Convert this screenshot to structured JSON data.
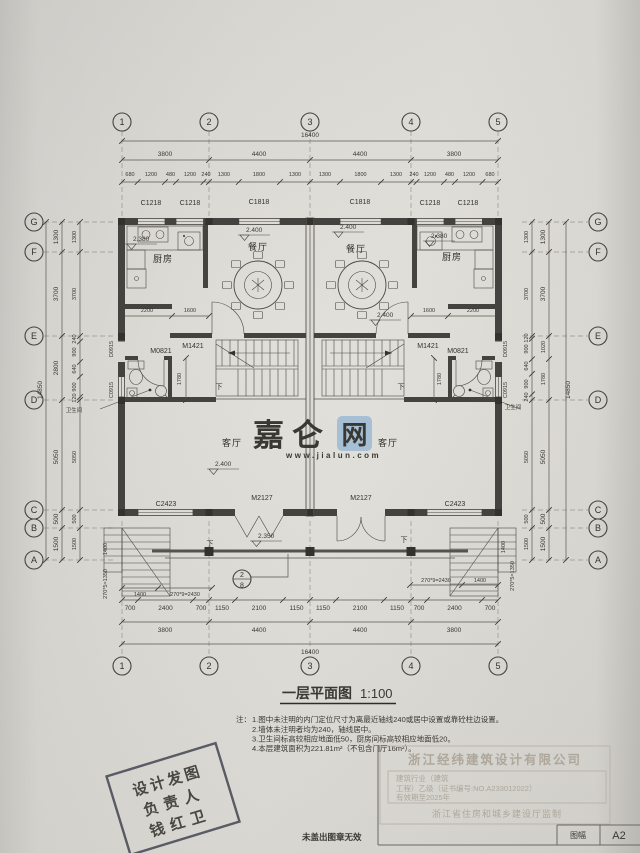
{
  "grid": {
    "cols": [
      "1",
      "2",
      "3",
      "4",
      "5"
    ],
    "rows": [
      "G",
      "F",
      "E",
      "D",
      "C",
      "B",
      "A"
    ]
  },
  "dims": {
    "top_total": "16400",
    "bays": [
      "3800",
      "4400",
      "4400",
      "3800"
    ],
    "top_detail": [
      "680",
      "1200",
      "480",
      "1200",
      "240",
      "1300",
      "1800",
      "1300",
      "1300",
      "1800",
      "1300",
      "240",
      "1200",
      "480",
      "1200",
      "680"
    ],
    "bottom_total": "16400",
    "bottom_detail": [
      "700",
      "2400",
      "700",
      "1150",
      "2100",
      "1150",
      "1150",
      "2100",
      "1150",
      "700",
      "2400",
      "700"
    ],
    "left_outer": [
      "1300",
      "3700",
      "2800",
      "5050",
      "500",
      "1500"
    ],
    "left_inner": [
      "1300",
      "3700",
      "240",
      "900",
      "640",
      "900",
      "120",
      "5050",
      "500",
      "1500"
    ],
    "right_inner": [
      "1300",
      "3700",
      "120",
      "900",
      "640",
      "900",
      "240",
      "5050",
      "500",
      "1500"
    ],
    "right_mid": [
      "1300",
      "3700",
      "1020",
      "1780",
      "5050",
      "500",
      "1500"
    ],
    "side_total": "14850",
    "kitchen_left": [
      "2200",
      "1600"
    ],
    "kitchen_right": [
      "1600",
      "2200"
    ],
    "stair_depth": "1780",
    "entry_left": [
      "1400",
      "270*9=2430"
    ],
    "entry_right": [
      "270*9=2430",
      "1400"
    ],
    "entry_side": [
      "1400",
      "270*5=1350"
    ]
  },
  "tags": {
    "c1218": "C1218",
    "c1818": "C1818",
    "c2423": "C2423",
    "m2127": "M2127",
    "m1421": "M1421",
    "m0821": "M0821",
    "d0915": "D0915",
    "c0915": "C0915"
  },
  "rooms": {
    "kitchen": "厨房",
    "dining": "餐厅",
    "living": "客厅",
    "bath": "卫生间",
    "down": "下"
  },
  "levels": {
    "dining": "2.400",
    "kitchen": "2.380",
    "hall": "2.400",
    "living": "2.400",
    "porch": "2.350"
  },
  "section": {
    "num": "2",
    "sheet": "8"
  },
  "title": {
    "name": "一层平面图",
    "scale": "1:100"
  },
  "notes": {
    "prefix": "注：",
    "items": [
      "1.图中未注明的内门定位尺寸为离最近轴线240或居中设置或靠砼柱边设置。",
      "2.墙体未注明者均为240，轴线居中。",
      "3.卫生间标高较相应地面低50，厨房间标高较相应地面低20。",
      "4.本层建筑面积为221.81m²（不包含门厅16m²）。"
    ]
  },
  "stamp": {
    "l1": "设计发图",
    "l2": "负责人",
    "l3": "钱红卫"
  },
  "cert": {
    "company": "浙江经纬建筑设计有限公司",
    "l1": "建筑行业（建筑",
    "l2": "工程）乙级（证书编号:NO.A233012022）",
    "l3": "有效期至2025年",
    "footer": "浙江省住房和城乡建设厅监制"
  },
  "seal_note": "未盖出图章无效",
  "sheet": {
    "label": "图幅",
    "value": "A2"
  },
  "watermark": {
    "main": "嘉仑",
    "boxed": "网",
    "url": "www.jialun.com"
  }
}
